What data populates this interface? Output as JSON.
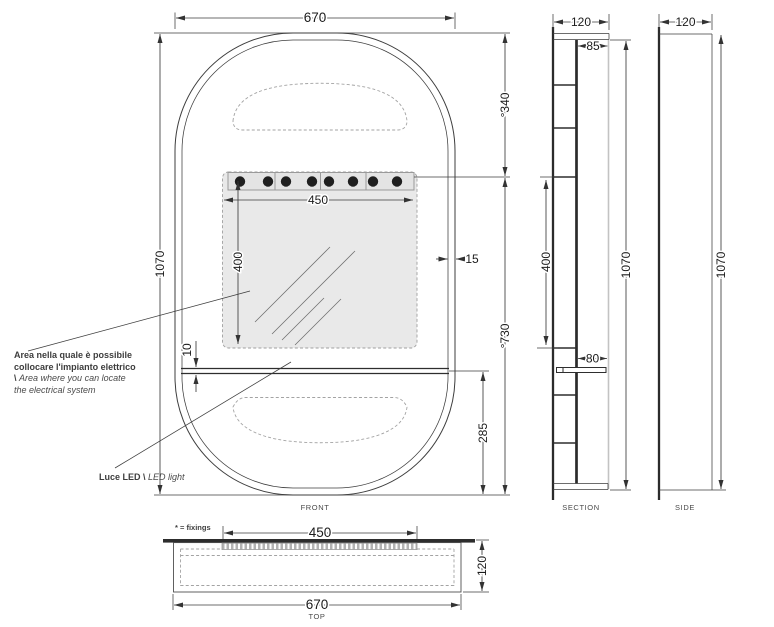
{
  "annotations": {
    "electrical_area_it": "Area nella quale è possibile collocare l'impianto elettrico \\",
    "electrical_area_en": "Area where you can locate the electrical system",
    "led_it": "Luce LED \\",
    "led_en": "LED light",
    "fixings": "* = fixings"
  },
  "front": {
    "label": "FRONT",
    "width": "670",
    "height": "1070",
    "upper_offset": "°340",
    "lower_offset": "°730",
    "led_width": "450",
    "area_height": "400",
    "edge_gap": "15",
    "shelf_thickness": "10",
    "bottom_section": "285"
  },
  "section": {
    "label": "SECTION",
    "depth": "120",
    "inner_depth": "85",
    "area_height": "400",
    "shelf_depth": "80",
    "height": "1070"
  },
  "side": {
    "label": "SIDE",
    "depth": "120",
    "height": "1070"
  },
  "top": {
    "label": "TOP",
    "led_width": "450",
    "depth": "120",
    "width": "670"
  },
  "colors": {
    "line": "#3d3d3d",
    "text": "#1b1b1b",
    "area_fill": "#e9e9e9",
    "mirror_bar": "#2d2d2d"
  }
}
